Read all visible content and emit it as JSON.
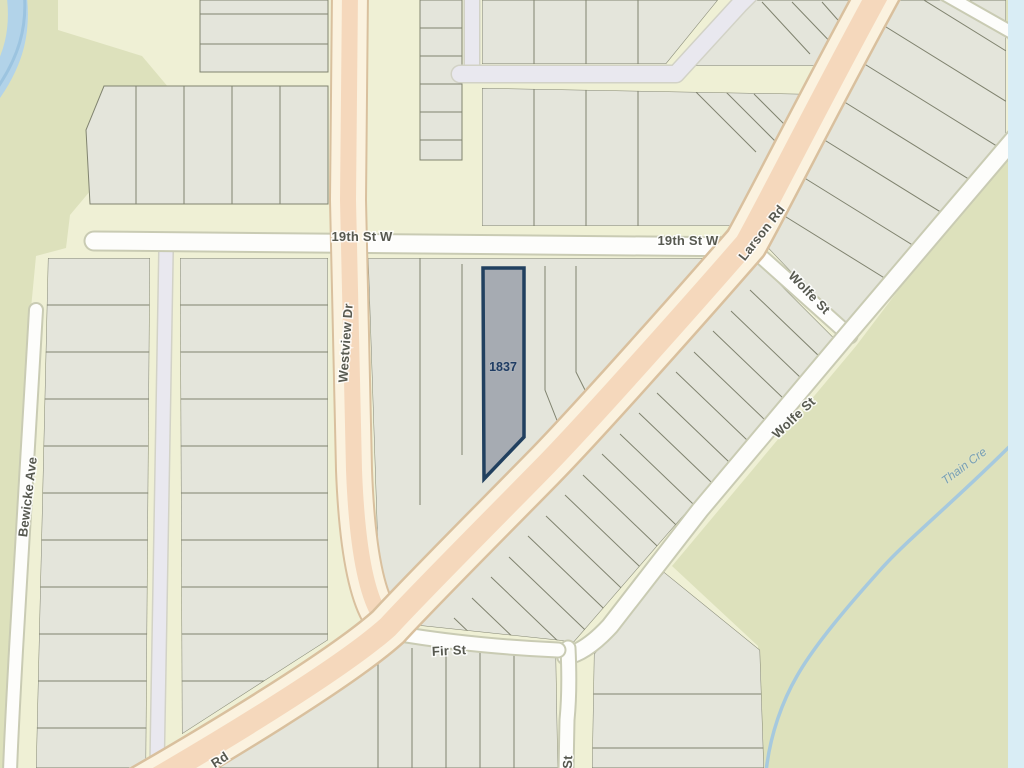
{
  "map": {
    "parcel": {
      "id": "1837",
      "fill": "#a6abb2",
      "stroke": "#21405f",
      "label_color": "#1f3c63"
    },
    "streets": {
      "nineteenth_left": "19th St W",
      "nineteenth_right": "19th St W",
      "westview": "Westview Dr",
      "larson": "Larson Rd",
      "larson_partial": "Rd",
      "wolfe_upper": "Wolfe St",
      "wolfe_mid": "Wolfe St",
      "wolfe_partial": "St",
      "bewicke": "Bewicke Ave",
      "fir": "Fir St"
    },
    "water": {
      "thain_creek": "Thain Cre"
    },
    "colors": {
      "block_base": "#eff0d5",
      "open_space": "#dde1bc",
      "lot_fill": "#e4e5db",
      "lot_line": "#80836f",
      "road_white": "#fdfdfb",
      "road_casing": "#c9cbb3",
      "road_major_center": "#f5d8bc",
      "road_major_edge": "#fbf2df",
      "road_major_casing": "#d9c09e",
      "lane": "#e9e8ef",
      "water_line": "#a6c9de",
      "map_edge_strip": "#d9edf5",
      "street_label": "#575950"
    }
  }
}
